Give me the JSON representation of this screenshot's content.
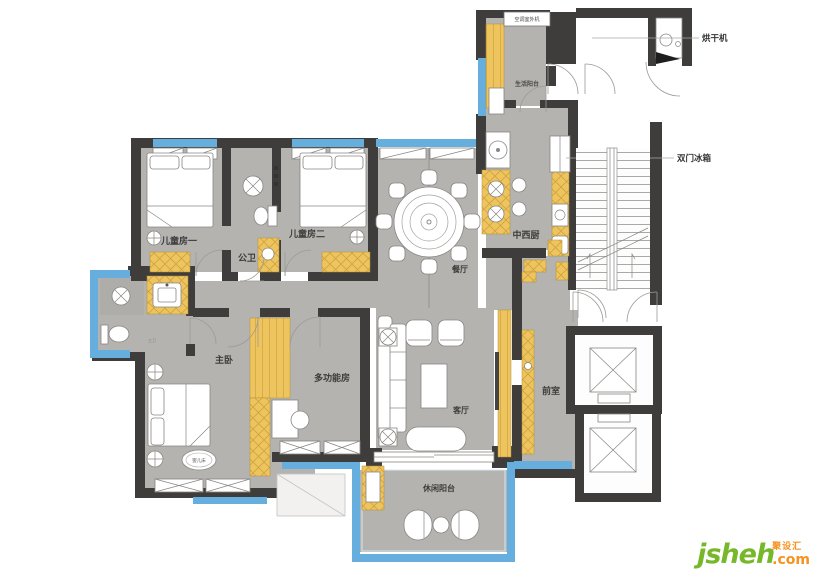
{
  "palette": {
    "wall": "#3e3d3b",
    "floor": "#b4b3b0",
    "cabinet": "#eec45f",
    "window_blue": "#66aede",
    "logo_green": "#76b82a",
    "logo_orange": "#f6921e"
  },
  "rooms": [
    {
      "id": "kids-room-1",
      "label": "儿童房一"
    },
    {
      "id": "public-bath",
      "label": "公卫"
    },
    {
      "id": "kids-room-2",
      "label": "儿童房二"
    },
    {
      "id": "dining",
      "label": "餐厅"
    },
    {
      "id": "kitchen",
      "label": "中西厨"
    },
    {
      "id": "service-balcony",
      "label": "生活阳台"
    },
    {
      "id": "master-bedroom",
      "label": "主卧"
    },
    {
      "id": "multi-function",
      "label": "多功能房"
    },
    {
      "id": "living",
      "label": "客厅"
    },
    {
      "id": "front-room",
      "label": "前室"
    },
    {
      "id": "leisure-balcony",
      "label": "休闲阳台"
    }
  ],
  "annotations": {
    "ac_unit": "空调室外机",
    "dryer": "烘干机",
    "fridge": "双门冰箱",
    "crib": "婴儿床",
    "master_bath": "主卫"
  },
  "logo": {
    "brand": "jsheh",
    "cn": "聚设汇",
    "tld": ".com"
  }
}
